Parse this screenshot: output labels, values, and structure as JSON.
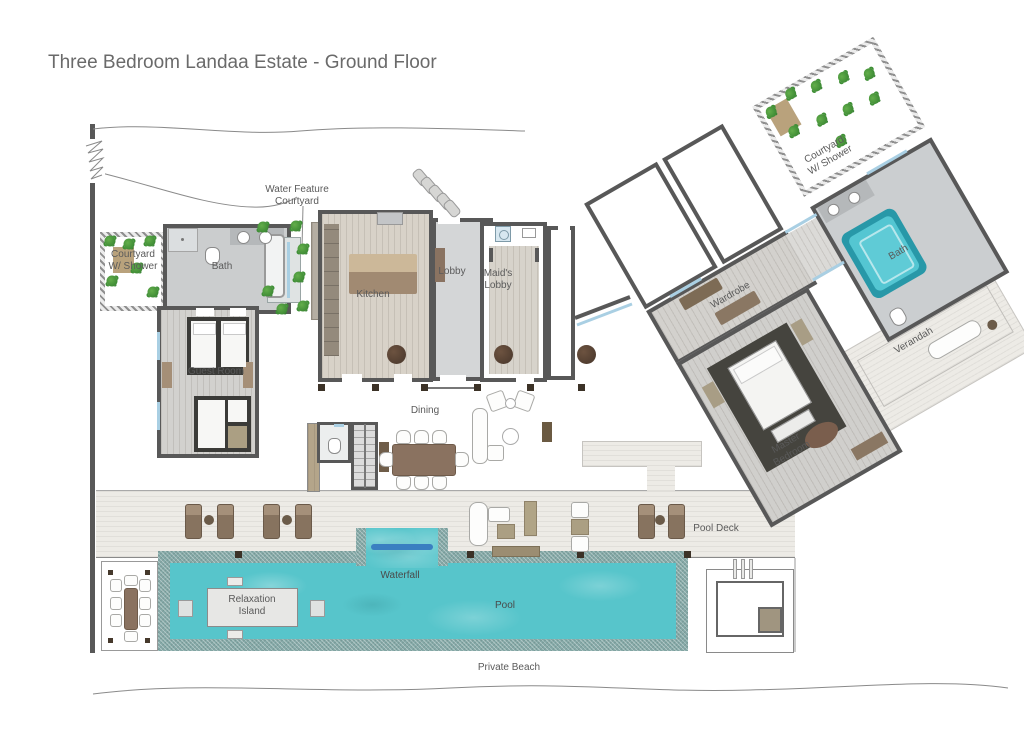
{
  "title": "Three Bedroom Landaa Estate - Ground Floor",
  "rooms": {
    "bath_left": "Bath",
    "guest_room": "Guest Room",
    "kitchen": "Kitchen",
    "lobby": "Lobby",
    "maids_lobby": "Maid's Lobby",
    "dining": "Dining",
    "wardrobe": "Wardrobe",
    "master_bedroom": "Master Bedroom",
    "master_bath": "Bath",
    "verandah": "Verandah"
  },
  "outdoor_labels": {
    "water_feature_courtyard": "Water Feature Courtyard",
    "courtyard_w_shower_left": "Courtyard W/ Shower",
    "courtyard_w_shower_right": "Courtyard W/ Shower",
    "pool_deck": "Pool Deck",
    "waterfall": "Waterfall",
    "relaxation_island": "Relaxation Island",
    "pool": "Pool",
    "private_beach": "Private Beach"
  },
  "colors": {
    "wall": "#585858",
    "pool_water": "#57c5cb",
    "pool_edge": "#84a9a7",
    "waterfall_bar": "#3a7fc1",
    "plant_green": "#3e8f35",
    "wood_furniture": "#8a7261",
    "label_text": "#5a5a5a",
    "title_text": "#6a6a6a"
  },
  "icons": {
    "plant": "foliage-dot",
    "column": "round-post",
    "waterfall_bar": "blue-bar"
  }
}
